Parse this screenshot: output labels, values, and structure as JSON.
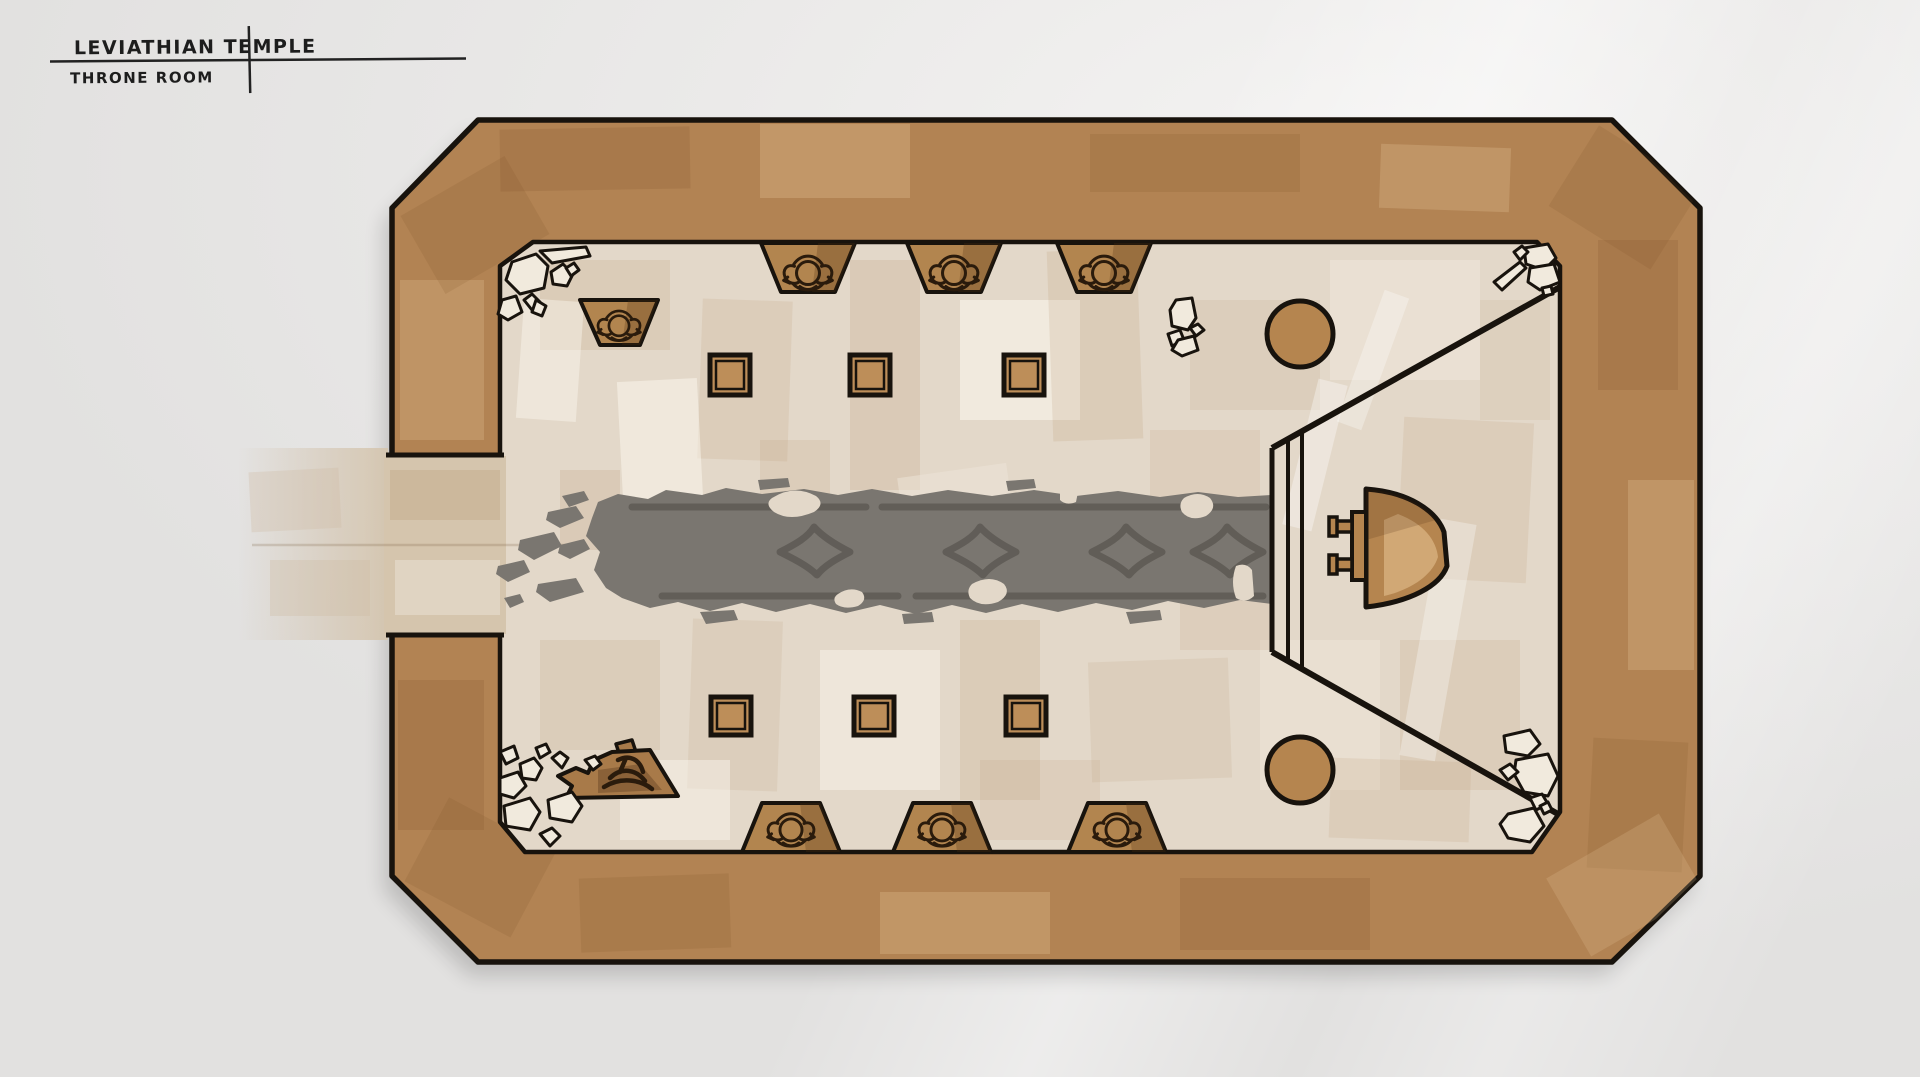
{
  "title": {
    "line1": "LEVIATHIAN TEMPLE",
    "line2": "THRONE ROOM"
  },
  "colors": {
    "background": "#ebeae9",
    "wall": "#b28353",
    "wall_shadow": "#9b7243",
    "floor": "#e3d8c9",
    "floor_light": "#f0e9dc",
    "accent_tan": "#b5854f",
    "pillar_tan": "#bd8e59",
    "alcove_tan": "#b2854f",
    "carpet": "#7a7670",
    "carpet_dark": "#5d5953",
    "corridor_wash": "#d5c5ad",
    "outline": "#18130d",
    "ink": "#1d1d1d"
  },
  "features": [
    {
      "name": "entrance-corridor",
      "count": 1
    },
    {
      "name": "brazier-alcove",
      "count": 7
    },
    {
      "name": "broken-alcove",
      "count": 1
    },
    {
      "name": "square-pillar",
      "count": 6
    },
    {
      "name": "round-column",
      "count": 2
    },
    {
      "name": "carpet-runner",
      "count": 1
    },
    {
      "name": "carpet-diamond-motif",
      "count": 4
    },
    {
      "name": "dais-step",
      "count": 3
    },
    {
      "name": "throne",
      "count": 1
    },
    {
      "name": "rubble-cluster",
      "count": 5
    }
  ]
}
